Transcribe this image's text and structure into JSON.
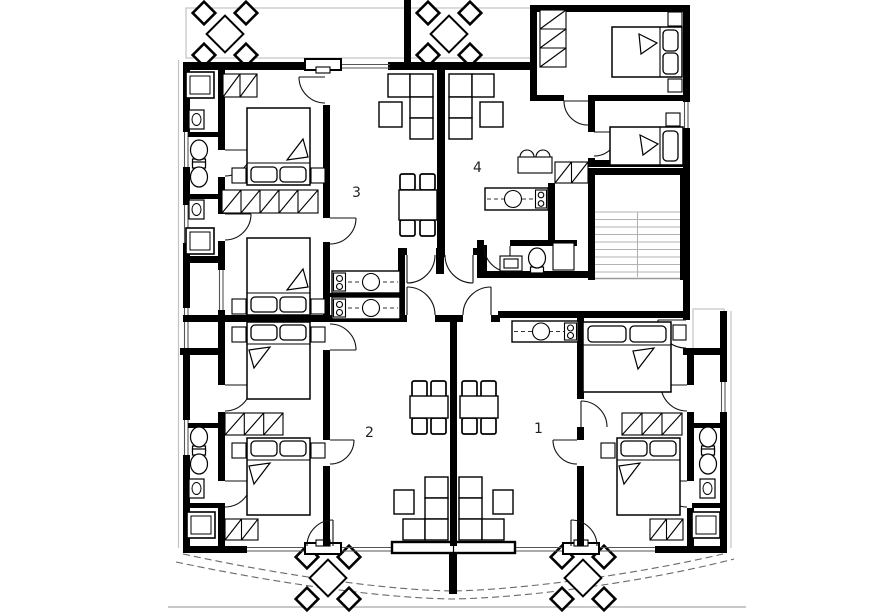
{
  "drawing": {
    "type": "architectural-floor-plan",
    "floor_units_count": 4
  },
  "canvas": {
    "width": 886,
    "height": 613
  },
  "colors": {
    "wall": "#000000",
    "background": "#ffffff",
    "terrace_line": "#c3c3c3",
    "stair_tread": "#b3b3b3",
    "terrace_dashed_edge": "#6a6a6a",
    "label_text": "#222222"
  },
  "units": [
    {
      "id": "unit-1",
      "label": "1",
      "position": "bottom-right",
      "furniture": [
        "double-bed",
        "double-bed",
        "wardrobe-hatched",
        "dining-table",
        "chairs",
        "sofa-modules",
        "armchair",
        "kitchen-counter",
        "sink",
        "stove",
        "toilet",
        "toilet",
        "washbasin",
        "shower-tray"
      ]
    },
    {
      "id": "unit-2",
      "label": "2",
      "position": "bottom-left",
      "furniture": [
        "double-bed",
        "double-bed",
        "wardrobe-hatched",
        "dining-table",
        "chairs",
        "sofa-modules",
        "armchair",
        "kitchen-counter",
        "sink",
        "stove",
        "toilet",
        "toilet",
        "washbasin",
        "shower-tray"
      ]
    },
    {
      "id": "unit-3",
      "label": "3",
      "position": "top-left",
      "furniture": [
        "double-bed",
        "double-bed",
        "wardrobe-hatched",
        "dining-table",
        "chairs",
        "sofa-modules",
        "armchair",
        "kitchen-counter",
        "sink",
        "stove",
        "toilet",
        "toilet",
        "washbasin",
        "shower-tray"
      ]
    },
    {
      "id": "unit-4",
      "label": "4",
      "position": "top-right",
      "furniture": [
        "double-bed",
        "single-bed",
        "wardrobe-hatched",
        "sofa-modules",
        "armchair",
        "kitchen-counter",
        "sink",
        "stove",
        "double-washbasin",
        "toilet",
        "washing-machine",
        "shower-cabin"
      ]
    }
  ],
  "shared_elements": [
    "staircase",
    "entrance-hall",
    "entrance-door",
    "entrance-porch",
    "terrace-top",
    "terrace-bottom",
    "patio-table-set",
    "patio-table-set",
    "patio-table-set",
    "patio-table-set",
    "balcony-sliding-door"
  ],
  "icon_glyphs": [
    "bed-icon",
    "pillow-icon",
    "wardrobe-hatch-icon",
    "toilet-icon",
    "washbasin-icon",
    "shower-icon",
    "sink-circle-icon",
    "stove-burners-icon",
    "door-arc-icon",
    "window-band-icon",
    "stair-treads-icon",
    "patio-set-icon"
  ]
}
